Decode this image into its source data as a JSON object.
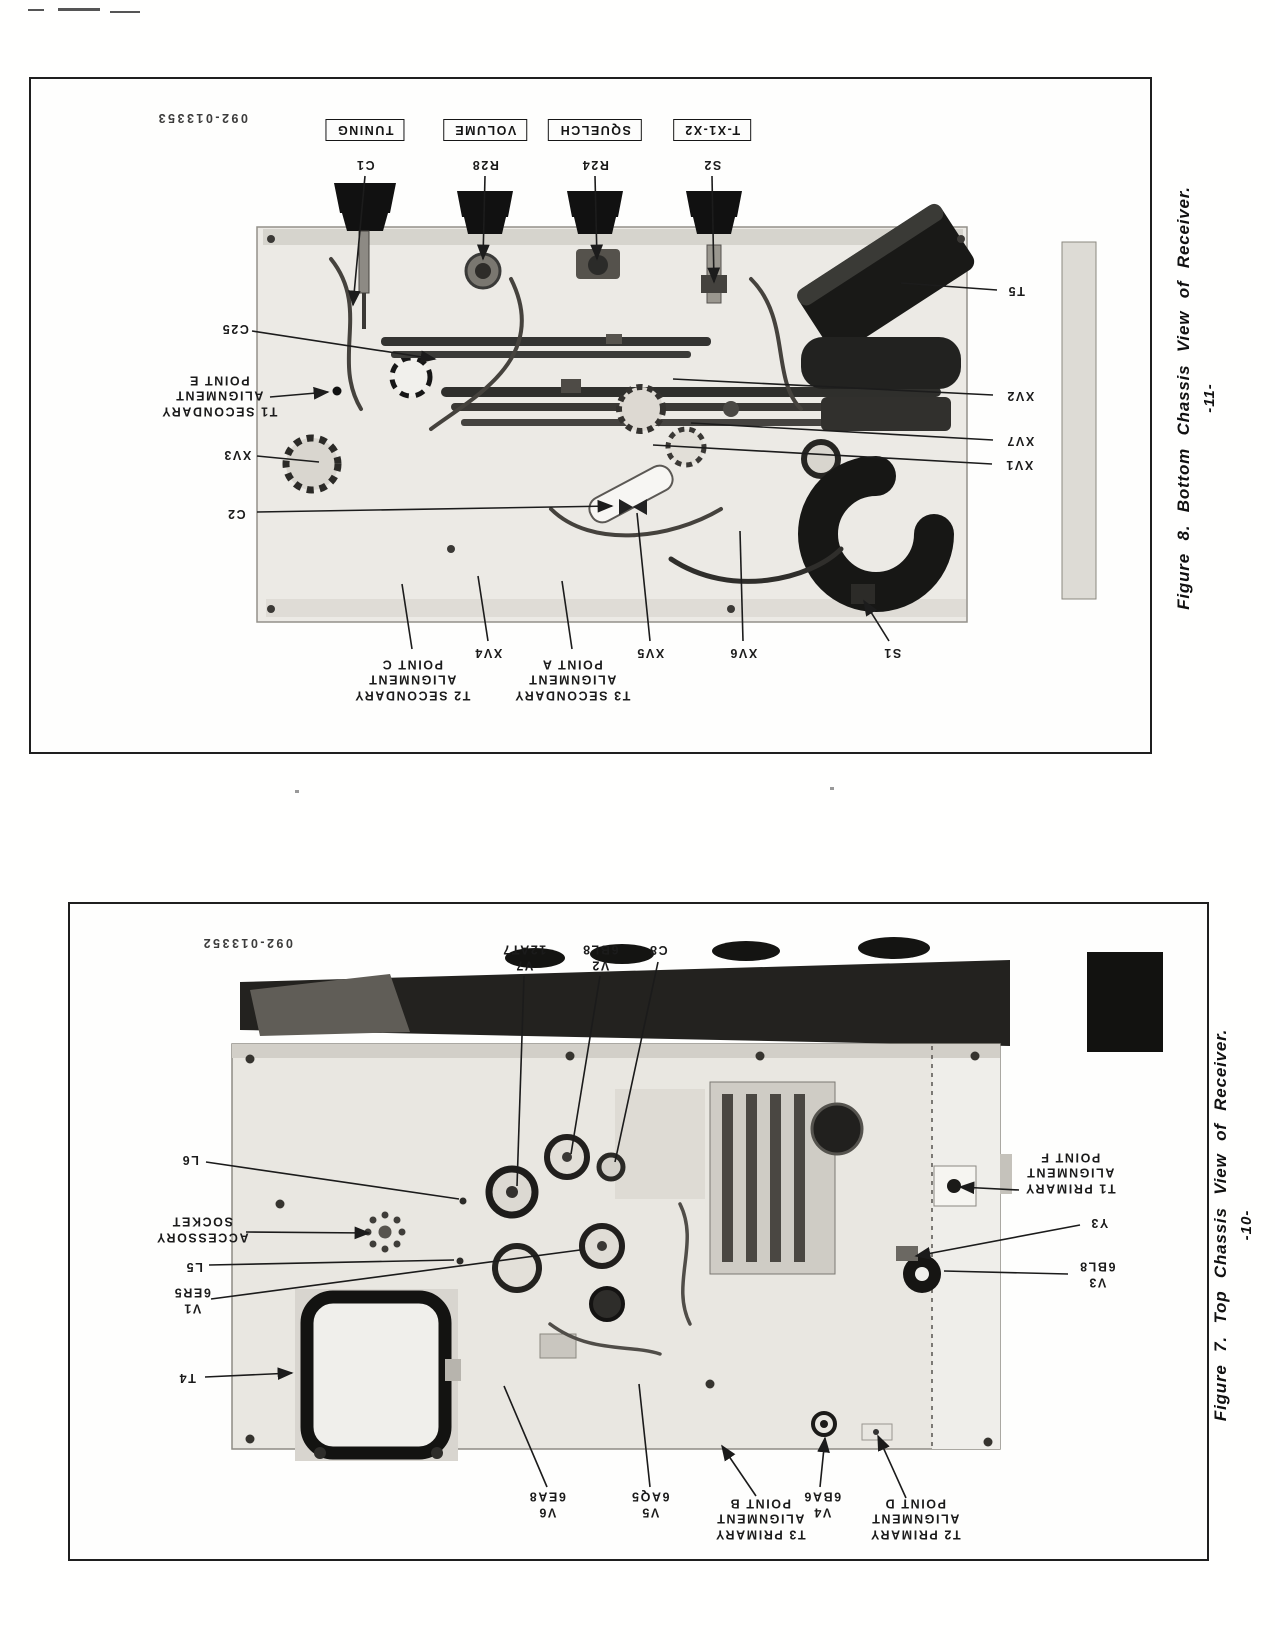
{
  "figure8": {
    "part_number": "092-013353",
    "caption": "Figure 8.  Bottom Chassis View of Receiver.",
    "page_number": "-11-",
    "controls": [
      {
        "label": "TUNING",
        "ref": "C1"
      },
      {
        "label": "VOLUME",
        "ref": "R28"
      },
      {
        "label": "SQUELCH",
        "ref": "R24"
      },
      {
        "label": "T-X1-X2",
        "ref": "S2"
      }
    ],
    "callouts": {
      "c25": "C25",
      "t1_secondary": [
        "T1 SECONDARY",
        "ALIGNMENT",
        "POINT E"
      ],
      "xv3": "XV3",
      "c2": "C2",
      "t5": "T5",
      "xv2": "XV2",
      "xv7": "XV7",
      "xv1": "XV1",
      "t2_secondary": [
        "T2 SECONDARY",
        "ALIGNMENT",
        "POINT C"
      ],
      "xv4": "XV4",
      "t3_secondary": [
        "T3 SECONDARY",
        "ALIGNMENT",
        "POINT A"
      ],
      "xv5": "XV5",
      "xv6": "XV6",
      "s1": "S1"
    }
  },
  "figure7": {
    "part_number": "092-013352",
    "caption": "Figure 7.  Top Chassis View of Receiver.",
    "page_number": "-10-",
    "callouts": {
      "v7": [
        "V7",
        "12AT7"
      ],
      "v2": [
        "V2",
        "6BL8"
      ],
      "c8": "C8",
      "l6": "L6",
      "accessory_socket": [
        "ACCESSORY",
        "SOCKET"
      ],
      "l5": "L5",
      "v1": [
        "V1",
        "6ER5"
      ],
      "t4": "T4",
      "t1_primary": [
        "T1 PRIMARY",
        "ALIGNMENT",
        "POINT F"
      ],
      "y3": "Y3",
      "v3": [
        "V3",
        "6BL8"
      ],
      "v6": [
        "V6",
        "6EA8"
      ],
      "v5": [
        "V5",
        "6AQ5"
      ],
      "t3_primary": [
        "T3 PRIMARY",
        "ALIGNMENT",
        "POINT B"
      ],
      "v4": [
        "V4",
        "6BA6"
      ],
      "t2_primary": [
        "T2 PRIMARY",
        "ALIGNMENT",
        "POINT D"
      ]
    }
  }
}
